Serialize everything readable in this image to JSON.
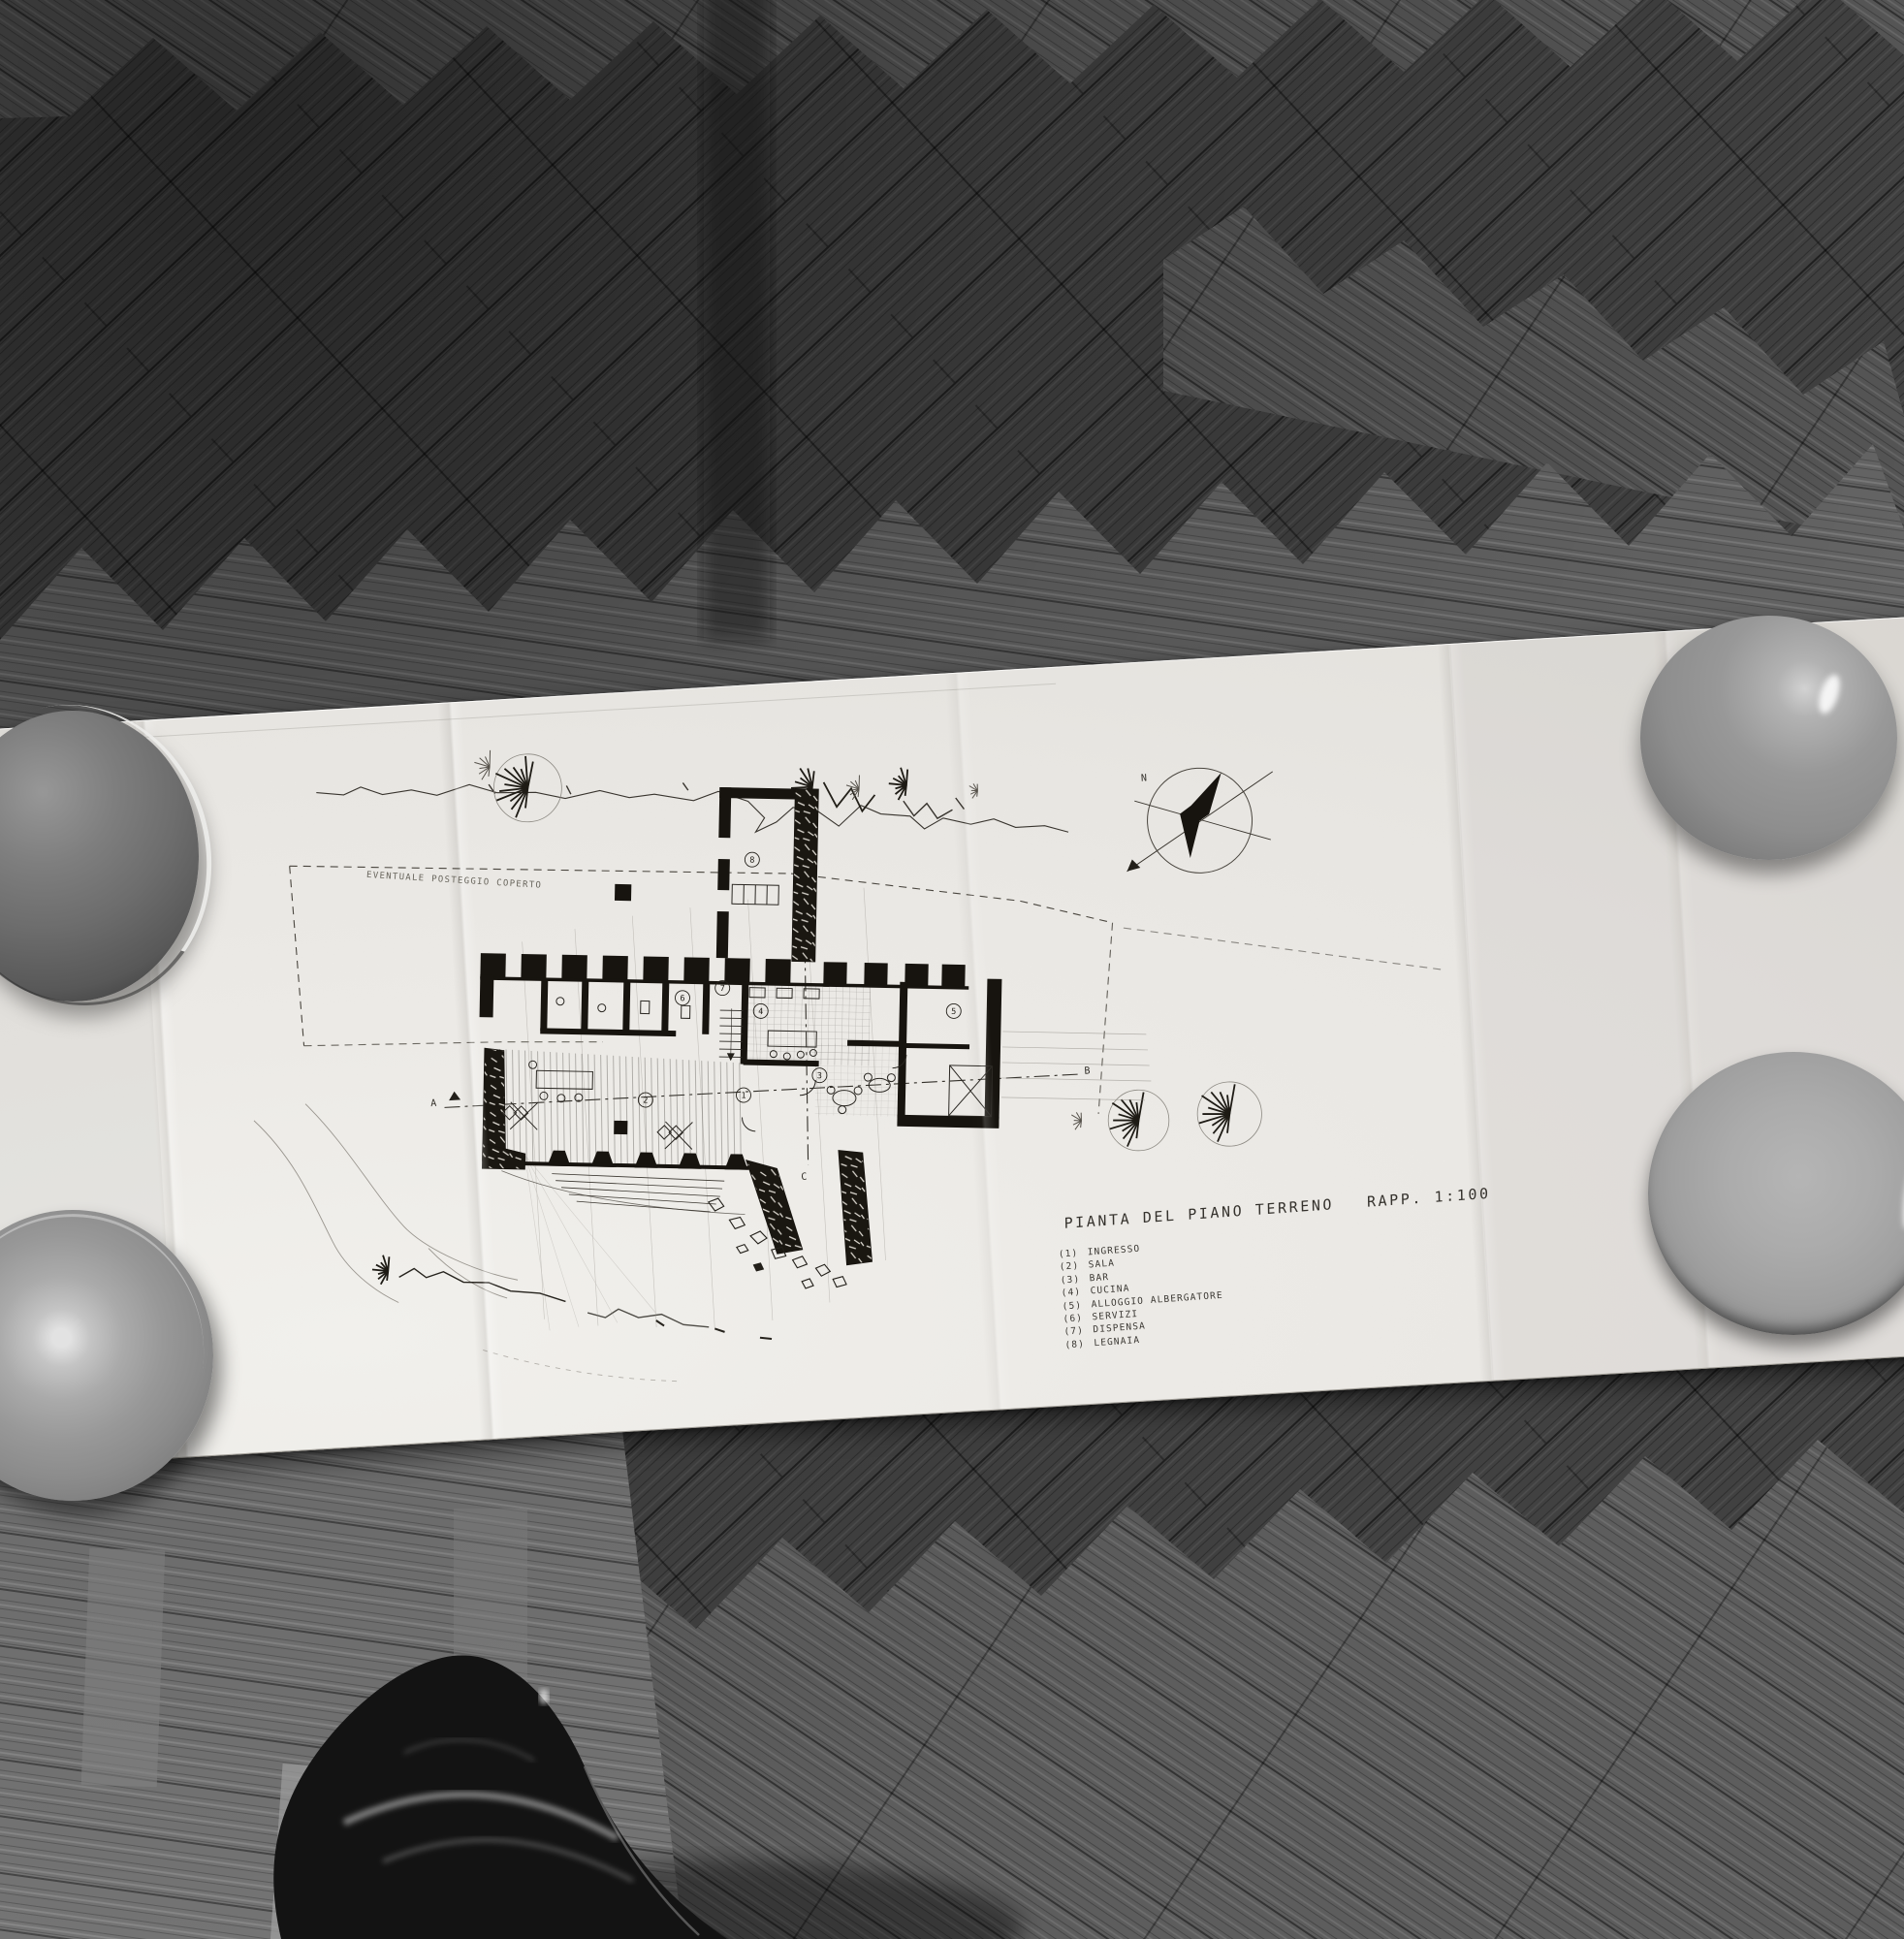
{
  "scene": {
    "kind": "black-and-white photograph",
    "description": "Unfolded architectural drawing lying on herringbone parquet, weighted with ceramic bowls, photographer's shoe at bottom",
    "objects": [
      "paper-architectural-drawing",
      "bowl-top-left",
      "plate-bottom-left",
      "bowl-top-right",
      "bowl-right-middle",
      "black-leather-shoe",
      "herringbone-parquet-floor"
    ]
  },
  "drawing": {
    "title": "PIANTA DEL PIANO TERRENO",
    "scale_label": "RAPP. 1:100",
    "site_annotation": "EVENTUALE POSTEGGIO COPERTO",
    "compass_label": "N",
    "section_labels": [
      "A",
      "B",
      "C",
      "D"
    ],
    "rooms": [
      {
        "number": "1",
        "name": "INGRESSO"
      },
      {
        "number": "2",
        "name": "SALA"
      },
      {
        "number": "3",
        "name": "BAR"
      },
      {
        "number": "4",
        "name": "CUCINA"
      },
      {
        "number": "5",
        "name": "ALLOGGIO ALBERGATORE"
      },
      {
        "number": "6",
        "name": "SERVIZI"
      },
      {
        "number": "7",
        "name": "DISPENSA"
      },
      {
        "number": "8",
        "name": "LEGNAIA"
      }
    ]
  },
  "colors": {
    "floor_dark": "#414141",
    "floor_light_band": "#646464",
    "floor_bottom_left": "#747474",
    "paper": "#eceae6",
    "ink": "#23211d",
    "pencil": "#8d8a85",
    "bowl_gray": "#9a9a9a",
    "shoe_black": "#131313"
  }
}
